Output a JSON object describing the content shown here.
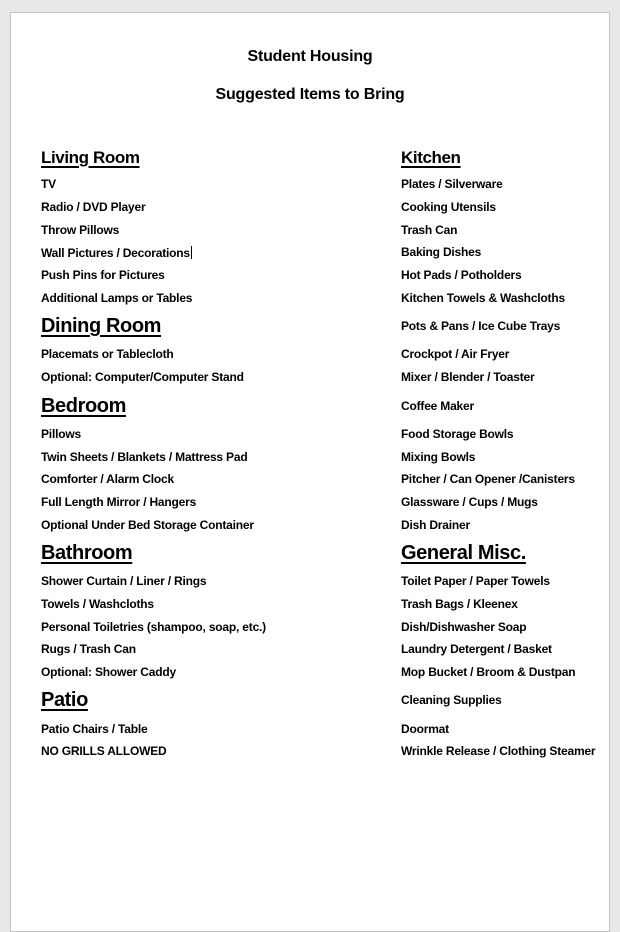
{
  "title": {
    "line1": "Student Housing",
    "line2": "Suggested Items to Bring"
  },
  "colors": {
    "canvas_bg": "#e8e8e8",
    "page_bg": "#ffffff",
    "page_border": "#c3c3c3",
    "text": "#000000"
  },
  "sections_left": [
    "Living Room",
    "Dining Room",
    "Bedroom",
    "Bathroom",
    "Patio"
  ],
  "sections_right": [
    "Kitchen",
    "General Misc."
  ],
  "rows": [
    {
      "left": {
        "text": "Living Room"
      },
      "right": {
        "text": "Kitchen"
      }
    },
    {
      "left": {
        "text": "TV"
      },
      "right": {
        "text": "Plates / Silverware"
      }
    },
    {
      "left": {
        "text": "Radio / DVD Player"
      },
      "right": {
        "text": "Cooking Utensils"
      }
    },
    {
      "left": {
        "text": "Throw Pillows"
      },
      "right": {
        "text": "Trash Can"
      }
    },
    {
      "left": {
        "text": "Wall Pictures / Decorations",
        "has_text_cursor": true
      },
      "right": {
        "text": "Baking Dishes"
      }
    },
    {
      "left": {
        "text": "Push Pins for Pictures"
      },
      "right": {
        "text": "Hot Pads / Potholders"
      }
    },
    {
      "left": {
        "text": "Additional Lamps or Tables"
      },
      "right": {
        "text": "Kitchen Towels & Washcloths"
      }
    },
    {
      "left": {
        "text": "Dining Room"
      },
      "right": {
        "text": "Pots & Pans / Ice Cube Trays"
      }
    },
    {
      "left": {
        "text": "Placemats or Tablecloth"
      },
      "right": {
        "text": "Crockpot / Air Fryer"
      }
    },
    {
      "left": {
        "text": "Optional: Computer/Computer Stand"
      },
      "right": {
        "text": "Mixer / Blender / Toaster"
      }
    },
    {
      "left": {
        "text": "Bedroom"
      },
      "right": {
        "text": "Coffee Maker"
      }
    },
    {
      "left": {
        "text": "Pillows"
      },
      "right": {
        "text": "Food Storage Bowls"
      }
    },
    {
      "left": {
        "text": "Twin Sheets / Blankets / Mattress Pad"
      },
      "right": {
        "text": "Mixing Bowls"
      }
    },
    {
      "left": {
        "text": "Comforter / Alarm Clock"
      },
      "right": {
        "text": "Pitcher / Can Opener /Canisters"
      }
    },
    {
      "left": {
        "text": "Full Length Mirror / Hangers"
      },
      "right": {
        "text": "Glassware / Cups / Mugs"
      }
    },
    {
      "left": {
        "text": "Optional Under Bed Storage Container"
      },
      "right": {
        "text": "Dish Drainer"
      }
    },
    {
      "left": {
        "text": "Bathroom"
      },
      "right": {
        "text": "General Misc."
      }
    },
    {
      "left": {
        "text": "Shower Curtain / Liner / Rings"
      },
      "right": {
        "text": "Toilet Paper / Paper Towels"
      }
    },
    {
      "left": {
        "text": "Towels / Washcloths"
      },
      "right": {
        "text": "Trash Bags / Kleenex"
      }
    },
    {
      "left": {
        "text": "Personal Toiletries (shampoo, soap, etc.)"
      },
      "right": {
        "text": "Dish/Dishwasher Soap"
      }
    },
    {
      "left": {
        "text": "Rugs / Trash Can"
      },
      "right": {
        "text": "Laundry Detergent / Basket"
      }
    },
    {
      "left": {
        "text": "Optional: Shower Caddy"
      },
      "right": {
        "text": "Mop Bucket / Broom & Dustpan"
      }
    },
    {
      "left": {
        "text": "Patio"
      },
      "right": {
        "text": "Cleaning Supplies"
      }
    },
    {
      "left": {
        "text": "Patio Chairs / Table"
      },
      "right": {
        "text": "Doormat"
      }
    },
    {
      "left": {
        "text": "NO GRILLS ALLOWED"
      },
      "right": {
        "text": "Wrinkle Release / Clothing Steamer"
      }
    }
  ]
}
